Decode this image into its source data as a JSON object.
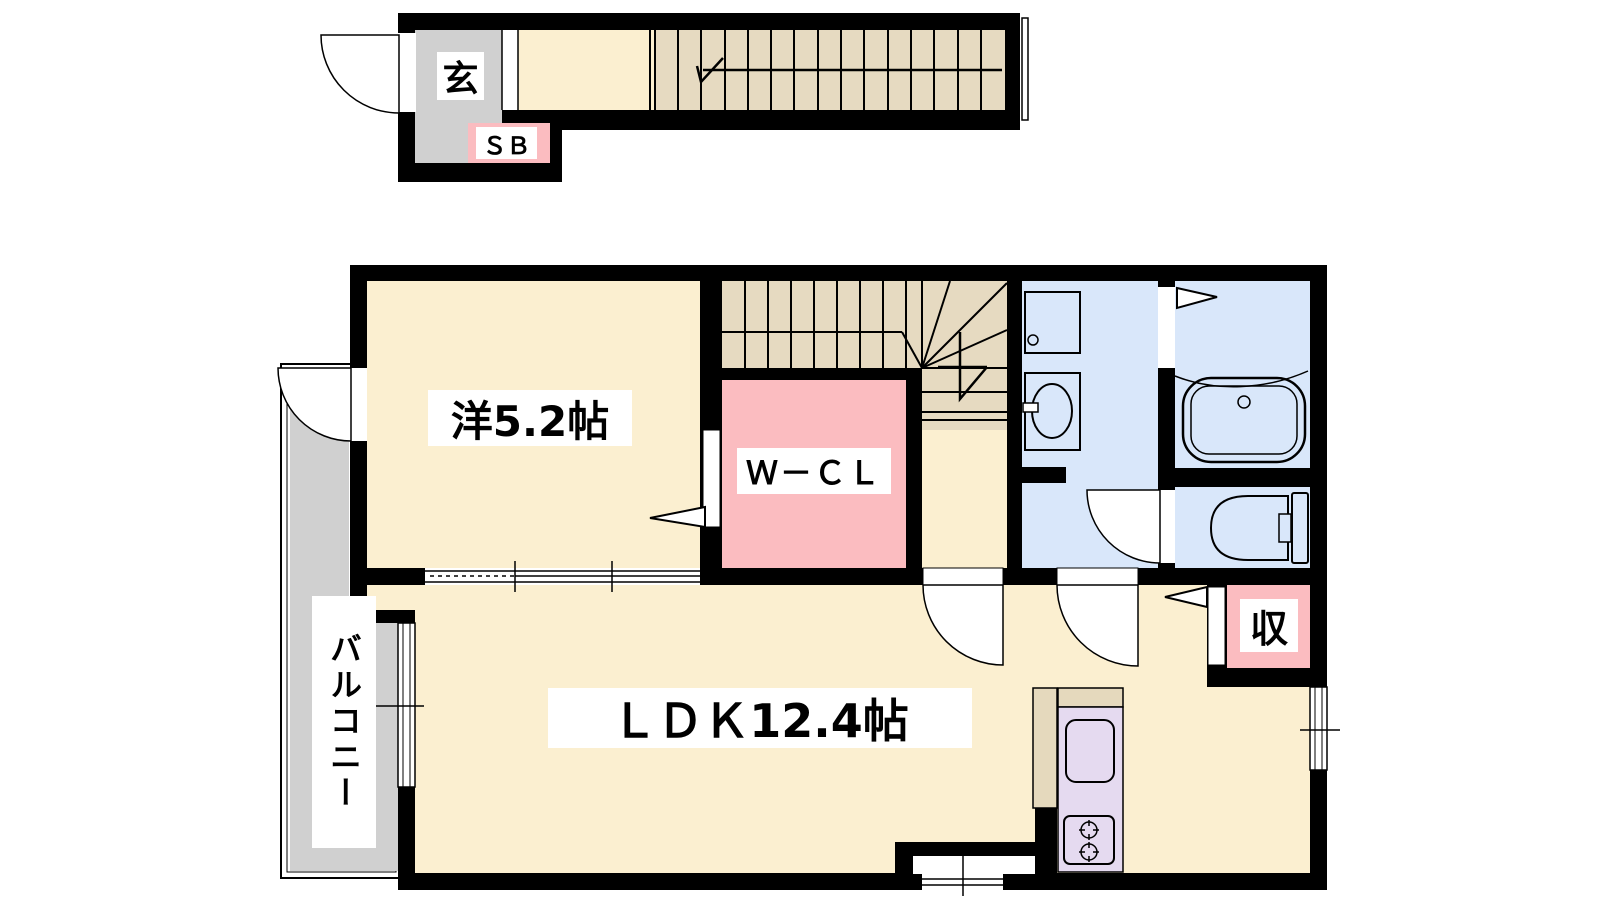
{
  "page": {
    "type": "apartment-floor-plan",
    "floors": [
      "entrance-stair-level",
      "main-level"
    ]
  },
  "labels": {
    "entrance": "玄",
    "shoe_box": "ＳＢ",
    "western_room": "洋5.2帖",
    "walk_in_closet": "Ｗ－ＣＬ",
    "ldk": "ＬＤＫ12.4帖",
    "balcony": "バルコニー",
    "storage": "収"
  },
  "colors": {
    "wall": "#000000",
    "room_floor": "#FBEFD0",
    "stairs": "#E6DAC1",
    "closet_pink": "#FBBCC0",
    "wet_area_blue": "#D9E7FA",
    "kitchen_purple": "#E5DAF0",
    "balcony_gray": "#D0D0D0",
    "counter_tan": "#E5D9BD",
    "background": "#FFFFFF"
  }
}
